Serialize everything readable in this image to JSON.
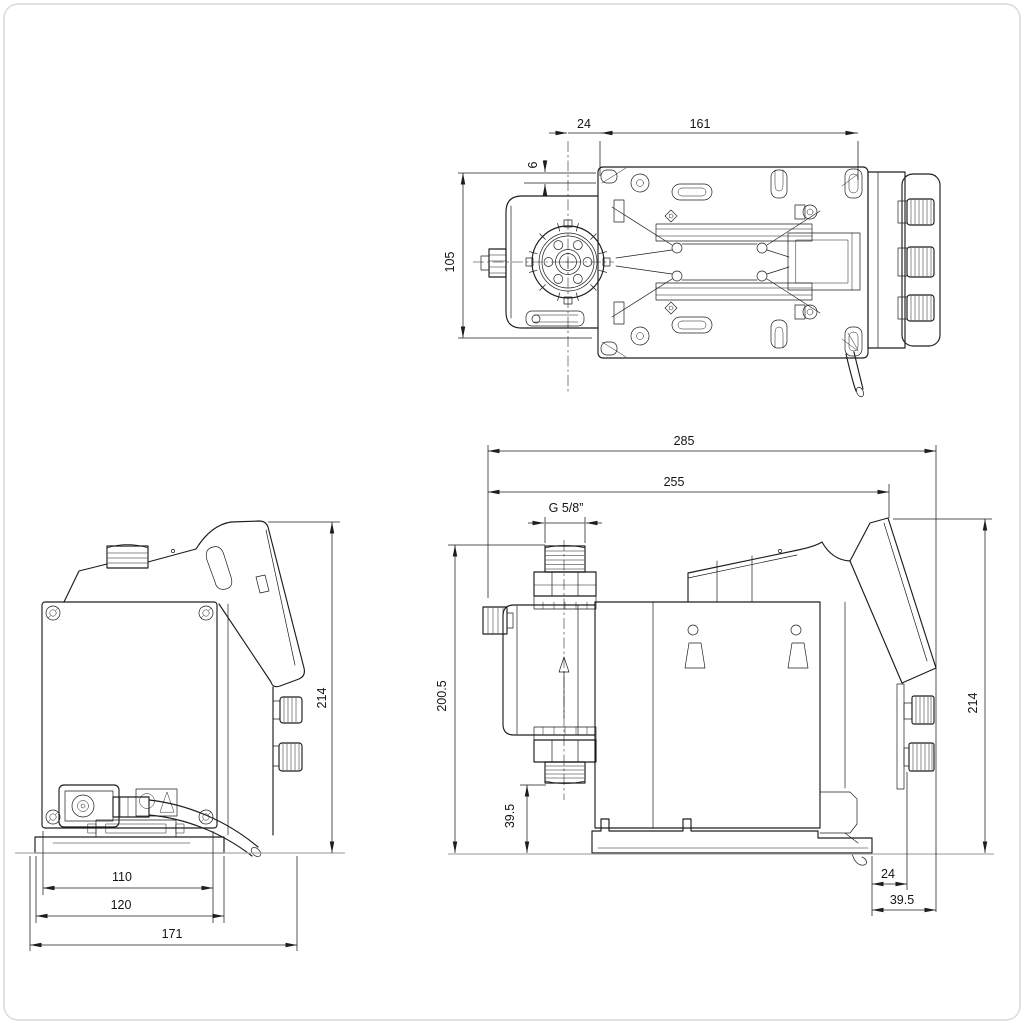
{
  "colors": {
    "line": "#1d1d1d",
    "background": "#ffffff",
    "ground_line": "#ababab",
    "frame": "#d9d9d9"
  },
  "dims": {
    "top": {
      "offset": "24",
      "mount_length": "161",
      "slot_height": "6",
      "mount_width": "105"
    },
    "front": {
      "height": "214",
      "face_width": "110",
      "base_width": "120",
      "overall_width": "171"
    },
    "side": {
      "overall_depth": "285",
      "depth_to_panel": "255",
      "thread": "G 5/8”",
      "discharge_height": "200.5",
      "suction_height": "39.5",
      "height": "214",
      "gland_offset": "24",
      "gland_depth": "39.5"
    }
  }
}
